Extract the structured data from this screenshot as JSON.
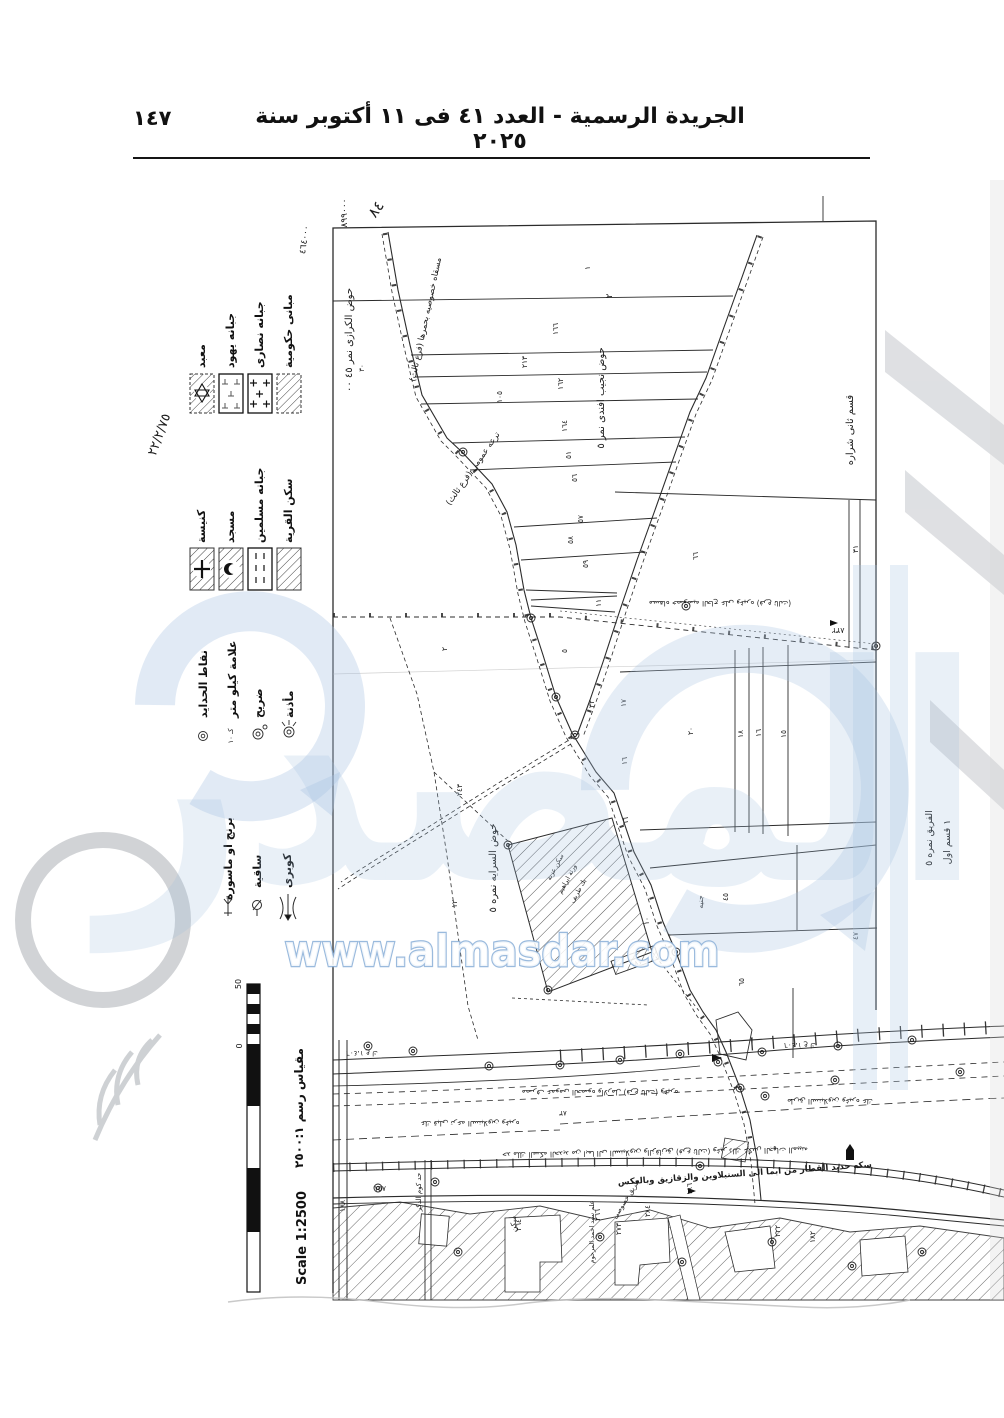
{
  "header": {
    "title": "الجريدة الرسمية - العدد ٤١ فى ١١ أكتوبر سنة ٢٠٢٥",
    "page_number": "١٤٧"
  },
  "watermark": {
    "url_text": "www.almasdar.com",
    "logo_text": "المصدر",
    "accent_color": "#8fb3d9"
  },
  "scale": {
    "title_ar": "مقياس رسم ٢٥٠٠:١",
    "title_en": "Scale 1:2500",
    "tick_max": "50",
    "tick_min": "0"
  },
  "legend": {
    "religious_buildings": [
      {
        "label": "مبانى حكومية",
        "symbol": "hatched-box"
      },
      {
        "label": "جبانه نصارى",
        "symbol": "crosses-box"
      },
      {
        "label": "جبانه يهود",
        "symbol": "t-marks-box"
      },
      {
        "label": "معبد",
        "symbol": "hatched-star-box"
      }
    ],
    "village_features": [
      {
        "label": "سكن القرية",
        "symbol": "hatched-box"
      },
      {
        "label": "جبانه مسلمين",
        "symbol": "dashes-box"
      },
      {
        "label": "مسجد",
        "symbol": "hatched-crescent-box"
      },
      {
        "label": "كنيسة",
        "symbol": "hatched-cross-box"
      }
    ],
    "point_symbols": [
      {
        "label": "مأذنة",
        "symbol": "minaret-mark"
      },
      {
        "label": "ضريح",
        "symbol": "shrine-mark"
      },
      {
        "label": "علامة كيلو متر",
        "symbol": "km-mark"
      },
      {
        "label": "نقاط الحدايد",
        "symbol": "iron-point-mark"
      }
    ],
    "structures": [
      {
        "label": "كوبرى",
        "symbol": "bridge-mark"
      },
      {
        "label": "ساقية",
        "symbol": "waterwheel-mark"
      },
      {
        "label": "برنج او ماسورة",
        "symbol": "pipe-mark"
      }
    ]
  },
  "map": {
    "annotations": [
      {
        "t": "٨٩٩٠٠٠",
        "x": 347,
        "y": 213,
        "r": -90,
        "s": 9
      },
      {
        "t": "٨٤",
        "x": 380,
        "y": 212,
        "r": -55,
        "s": 15
      },
      {
        "t": "٤٦٤٠٠٠",
        "x": 307,
        "y": 240,
        "r": -82,
        "s": 9
      },
      {
        "t": "٢٢/٢/٧٥",
        "x": 163,
        "y": 436,
        "r": -70,
        "s": 13
      },
      {
        "t": "حوض الكرازى نمر ٤٥ ٠٠",
        "x": 352,
        "y": 340,
        "r": -90,
        "s": 10
      },
      {
        "t": "٣٠",
        "x": 364,
        "y": 368,
        "r": -90,
        "s": 7
      },
      {
        "t": "مسقاه خصوصيه بحمرها (فرع ثالث)",
        "x": 428,
        "y": 320,
        "r": -78,
        "s": 8.5
      },
      {
        "t": "ترعه عمومى (فرع ثالث)",
        "x": 475,
        "y": 470,
        "r": -55,
        "s": 8.5
      },
      {
        "t": "حوض نجيب افندى نمر ٥",
        "x": 604,
        "y": 398,
        "r": -90,
        "s": 10
      },
      {
        "t": "٢",
        "x": 612,
        "y": 296,
        "r": -90,
        "s": 9
      },
      {
        "t": "قسم ثانى شراره",
        "x": 853,
        "y": 430,
        "r": -90,
        "s": 10
      },
      {
        "t": "مسقاه خصوصيه الحاج على وغيره (فرع ثالث)",
        "x": 720,
        "y": 601,
        "r": 180,
        "s": 7.5
      },
      {
        "t": "٨٣٢",
        "x": 838,
        "y": 628,
        "r": 180,
        "s": 8
      },
      {
        "t": "حوض السرايه نمره ٥",
        "x": 496,
        "y": 868,
        "r": -90,
        "s": 10
      },
      {
        "t": "سكن عزبة",
        "x": 557,
        "y": 868,
        "r": -62,
        "s": 6.5
      },
      {
        "t": "ورثة ابراهيم",
        "x": 569,
        "y": 880,
        "r": -62,
        "s": 6.5
      },
      {
        "t": "بك طريف",
        "x": 580,
        "y": 892,
        "r": -62,
        "s": 6.5
      },
      {
        "t": "جنيه",
        "x": 703,
        "y": 902,
        "r": -90,
        "s": 7.5
      },
      {
        "t": "الفريق نمره ٥",
        "x": 932,
        "y": 838,
        "r": -90,
        "s": 9.5
      },
      {
        "t": "١ قسم اول",
        "x": 950,
        "y": 842,
        "r": -90,
        "s": 9.5
      },
      {
        "t": "٤٧",
        "x": 858,
        "y": 936,
        "r": -90,
        "s": 7.5
      },
      {
        "t": "١٨١",
        "x": 637,
        "y": 965,
        "r": -20,
        "s": 6.5
      },
      {
        "t": "١",
        "x": 590,
        "y": 268,
        "r": -90,
        "s": 7.5
      },
      {
        "t": "١٦٦",
        "x": 558,
        "y": 329,
        "r": -90,
        "s": 7.5
      },
      {
        "t": "٢١٣",
        "x": 527,
        "y": 362,
        "r": -90,
        "s": 7.5
      },
      {
        "t": "١٦٢",
        "x": 563,
        "y": 384,
        "r": -90,
        "s": 7.5
      },
      {
        "t": "١٠٥",
        "x": 502,
        "y": 397,
        "r": -90,
        "s": 7.5
      },
      {
        "t": "١٦٤",
        "x": 567,
        "y": 426,
        "r": -90,
        "s": 7.5
      },
      {
        "t": "٥١",
        "x": 571,
        "y": 455,
        "r": -90,
        "s": 7.5
      },
      {
        "t": "٥٦",
        "x": 577,
        "y": 478,
        "r": -90,
        "s": 7.5
      },
      {
        "t": "٥٧",
        "x": 583,
        "y": 519,
        "r": -90,
        "s": 7.5
      },
      {
        "t": "٥٨",
        "x": 573,
        "y": 540,
        "r": -90,
        "s": 7.5
      },
      {
        "t": "٥٩",
        "x": 588,
        "y": 564,
        "r": -90,
        "s": 7.5
      },
      {
        "t": "١١",
        "x": 601,
        "y": 603,
        "r": -90,
        "s": 7.5
      },
      {
        "t": "٥",
        "x": 567,
        "y": 651,
        "r": -90,
        "s": 7.5
      },
      {
        "t": "٣٢",
        "x": 594,
        "y": 704,
        "r": -90,
        "s": 7.5
      },
      {
        "t": "٦٦",
        "x": 698,
        "y": 556,
        "r": -90,
        "s": 7.5
      },
      {
        "t": "٣١",
        "x": 858,
        "y": 549,
        "r": -90,
        "s": 7.5
      },
      {
        "t": "٢٠",
        "x": 693,
        "y": 731,
        "r": -90,
        "s": 7.5
      },
      {
        "t": "١٨",
        "x": 743,
        "y": 734,
        "r": -90,
        "s": 7.5
      },
      {
        "t": "١٦",
        "x": 761,
        "y": 733,
        "r": -90,
        "s": 7.5
      },
      {
        "t": "١٥",
        "x": 786,
        "y": 734,
        "r": -90,
        "s": 7.5
      },
      {
        "t": "١٧",
        "x": 626,
        "y": 703,
        "r": -90,
        "s": 7.5
      },
      {
        "t": "١٦",
        "x": 627,
        "y": 761,
        "r": -90,
        "s": 7.5
      },
      {
        "t": "٢",
        "x": 447,
        "y": 649,
        "r": -90,
        "s": 7.5
      },
      {
        "t": "١٢",
        "x": 457,
        "y": 904,
        "r": -90,
        "s": 7.5
      },
      {
        "t": "٢٤٣",
        "x": 462,
        "y": 790,
        "r": -90,
        "s": 7.5
      },
      {
        "t": "٦٦",
        "x": 628,
        "y": 821,
        "r": -90,
        "s": 7.5
      },
      {
        "t": "١٠",
        "x": 649,
        "y": 921,
        "r": -90,
        "s": 7.5
      },
      {
        "t": "٤٥",
        "x": 728,
        "y": 897,
        "r": -90,
        "s": 7.5
      },
      {
        "t": "٦٥",
        "x": 744,
        "y": 982,
        "r": -90,
        "s": 7.5
      },
      {
        "t": "١،٤٠٦ ع ك",
        "x": 362,
        "y": 1051,
        "r": 180,
        "s": 7
      },
      {
        "t": "١،٤٠٦ ع ك",
        "x": 800,
        "y": 1043,
        "r": 180,
        "s": 7
      },
      {
        "t": "مصرف عمومى الحصوه والارمل (فرع ثالث) وغيره",
        "x": 600,
        "y": 1090,
        "r": 180,
        "s": 7.5
      },
      {
        "t": "طريق السنبلاوين وغيره عك",
        "x": 830,
        "y": 1099,
        "r": 180,
        "s": 7.5
      },
      {
        "t": "عك قبلى ترعه السنبلاوين وغيره",
        "x": 470,
        "y": 1121,
        "r": 180,
        "s": 7.5
      },
      {
        "t": "٨٣",
        "x": 563,
        "y": 1111,
        "r": 180,
        "s": 7
      },
      {
        "t": "حد ملك السكه الحديد من ابما الى السنبلاوين والزقازيق (فرع ثالث) وغير ذلك عكس الجهات المبينه",
        "x": 655,
        "y": 1150,
        "r": 179,
        "s": 7.5
      },
      {
        "t": "سكه حديد القطار من ابما الى السنبلاوين والزقازيق وبالعكس",
        "x": 745,
        "y": 1176,
        "r": -4,
        "s": 8.5,
        "b": 1
      },
      {
        "t": "طريق خصوصى",
        "x": 628,
        "y": 1200,
        "r": -58,
        "s": 7
      },
      {
        "t": "حد كوم الدكر",
        "x": 421,
        "y": 1192,
        "r": -90,
        "s": 7
      },
      {
        "t": "سكن",
        "x": 516,
        "y": 1224,
        "r": -90,
        "s": 7.5
      },
      {
        "t": "علم سيد احمد المرحوم",
        "x": 594,
        "y": 1232,
        "r": -90,
        "s": 6.5
      },
      {
        "t": "١٥٧",
        "x": 380,
        "y": 1191,
        "r": 0,
        "s": 7.5
      },
      {
        "t": "١٨٨",
        "x": 345,
        "y": 1206,
        "r": -90,
        "s": 7.5
      },
      {
        "t": "٢٦٤",
        "x": 521,
        "y": 1225,
        "r": -90,
        "s": 7.5
      },
      {
        "t": "٢٦٦",
        "x": 600,
        "y": 1215,
        "r": -90,
        "s": 7.5
      },
      {
        "t": "٢٧٣",
        "x": 621,
        "y": 1229,
        "r": -90,
        "s": 7.5
      },
      {
        "t": "٢٨٤",
        "x": 650,
        "y": 1211,
        "r": -90,
        "s": 7.5
      },
      {
        "t": "١٨٦",
        "x": 692,
        "y": 1189,
        "r": -90,
        "s": 7.5
      },
      {
        "t": "٢٢٢",
        "x": 780,
        "y": 1231,
        "r": -90,
        "s": 7.5
      },
      {
        "t": "١٨٢",
        "x": 815,
        "y": 1237,
        "r": -90,
        "s": 7.5
      },
      {
        "t": "كـ ١٠",
        "x": 233,
        "y": 736,
        "r": -90,
        "s": 7
      }
    ]
  }
}
